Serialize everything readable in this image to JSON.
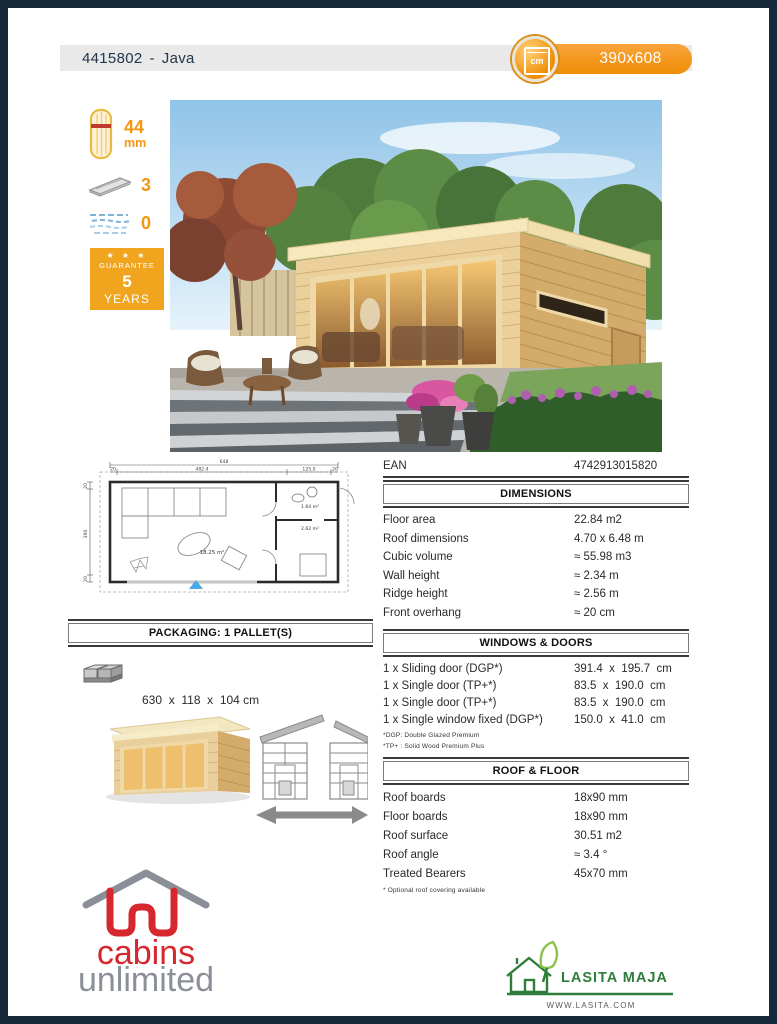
{
  "header": {
    "code": "4415802",
    "separator": "-",
    "name": "Java",
    "size": "390x608",
    "unit_label": "cm"
  },
  "left_panel": {
    "wall_thickness_value": "44",
    "wall_thickness_unit": "mm",
    "pallets_value": "3",
    "glazing_value": "0",
    "guarantee": {
      "stars": "★ ★ ★",
      "label": "GUARANTEE",
      "value": "5",
      "unit": "YEARS"
    }
  },
  "ean": {
    "label": "EAN",
    "value": "4742913015820"
  },
  "dimensions": {
    "title": "DIMENSIONS",
    "rows": [
      {
        "label": "Floor area",
        "value": "22.84 m2"
      },
      {
        "label": "Roof dimensions",
        "value": "4.70 x 6.48 m"
      },
      {
        "label": "Cubic volume",
        "value": "≈ 55.98 m3"
      },
      {
        "label": "Wall height",
        "value": "≈ 2.34 m"
      },
      {
        "label": "Ridge height",
        "value": "≈ 2.56 m"
      },
      {
        "label": "Front overhang",
        "value": "≈ 20 cm"
      }
    ]
  },
  "windows_doors": {
    "title": "WINDOWS & DOORS",
    "rows": [
      {
        "label": "1 x Sliding door (DGP*)",
        "value": "391.4  x  195.7  cm"
      },
      {
        "label": "1 x Single door (TP+*)",
        "value": "83.5  x  190.0  cm"
      },
      {
        "label": "1 x Single door (TP+*)",
        "value": "83.5  x  190.0  cm"
      },
      {
        "label": "1 x Single window fixed (DGP*)",
        "value": "150.0  x  41.0  cm"
      }
    ],
    "footnote1": "*DGP: Double Glazed Premium",
    "footnote2": "*TP+ : Solid Wood Premium Plus"
  },
  "packaging": {
    "title": "PACKAGING: 1 PALLET(S)",
    "dimensions": "630  x  118  x  104 cm",
    "weight": "2350 kg"
  },
  "roof_floor": {
    "title": "ROOF & FLOOR",
    "rows": [
      {
        "label": "Roof boards",
        "value": "18x90 mm"
      },
      {
        "label": "Floor boards",
        "value": "18x90 mm"
      },
      {
        "label": "Roof surface",
        "value": "30.51 m2"
      },
      {
        "label": "Roof angle",
        "value": "≈ 3.4 °"
      },
      {
        "label": "Treated Bearers",
        "value": "45x70 mm"
      }
    ],
    "footnote": "* Optional roof covering available"
  },
  "floor_plan": {
    "dim_total": "648",
    "dim_left_pad": "20",
    "dim_main": "482.4",
    "dim_side": "125.0",
    "dim_right_pad": "20",
    "dim_v_pad_top": "20",
    "dim_height": "390",
    "dim_v_pad_bottom": "20",
    "room_main": "18.25 m²",
    "room_top": "1.64 m²",
    "room_bottom": "2.62 m²"
  },
  "logos": {
    "cabins_line1": "cabins",
    "cabins_line2": "unlimited",
    "lasita_name": "LASITA MAJA",
    "lasita_url": "WWW.LASITA.COM"
  },
  "colors": {
    "border_navy": "#16293b",
    "accent_orange": "#f49712",
    "guarantee_orange": "#f1a51f",
    "badge_orange": "#ef8d04",
    "cabins_red": "#d6272e",
    "cabins_gray": "#8a8f98",
    "lasita_green": "#2e7d3a"
  }
}
